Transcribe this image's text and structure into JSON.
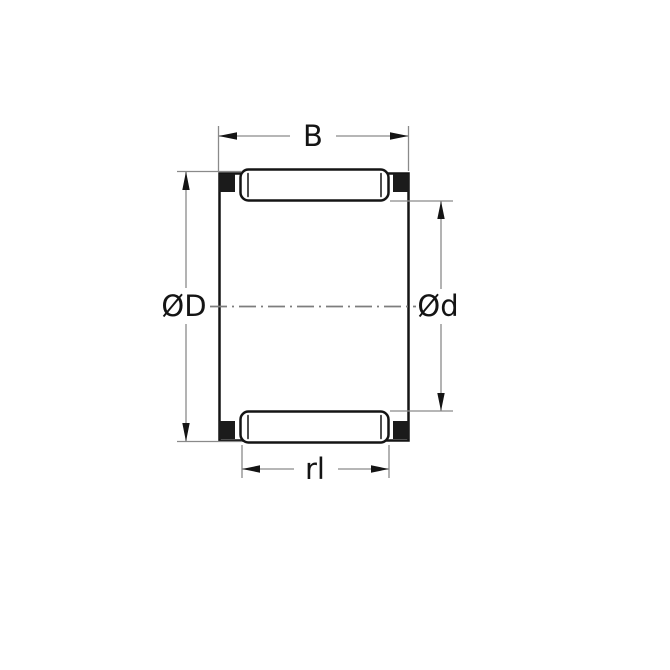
{
  "diagram": {
    "labels": {
      "width": "B",
      "outer_diameter": "ØD",
      "inner_diameter": "Ød",
      "roller_length": "rl"
    },
    "colors": {
      "background": "#ffffff",
      "outline": "#141414",
      "dimension_line": "#8a8a8a",
      "centerline": "#7d7d7d",
      "text": "#141414",
      "cage_end": "#1b1b1b"
    }
  }
}
